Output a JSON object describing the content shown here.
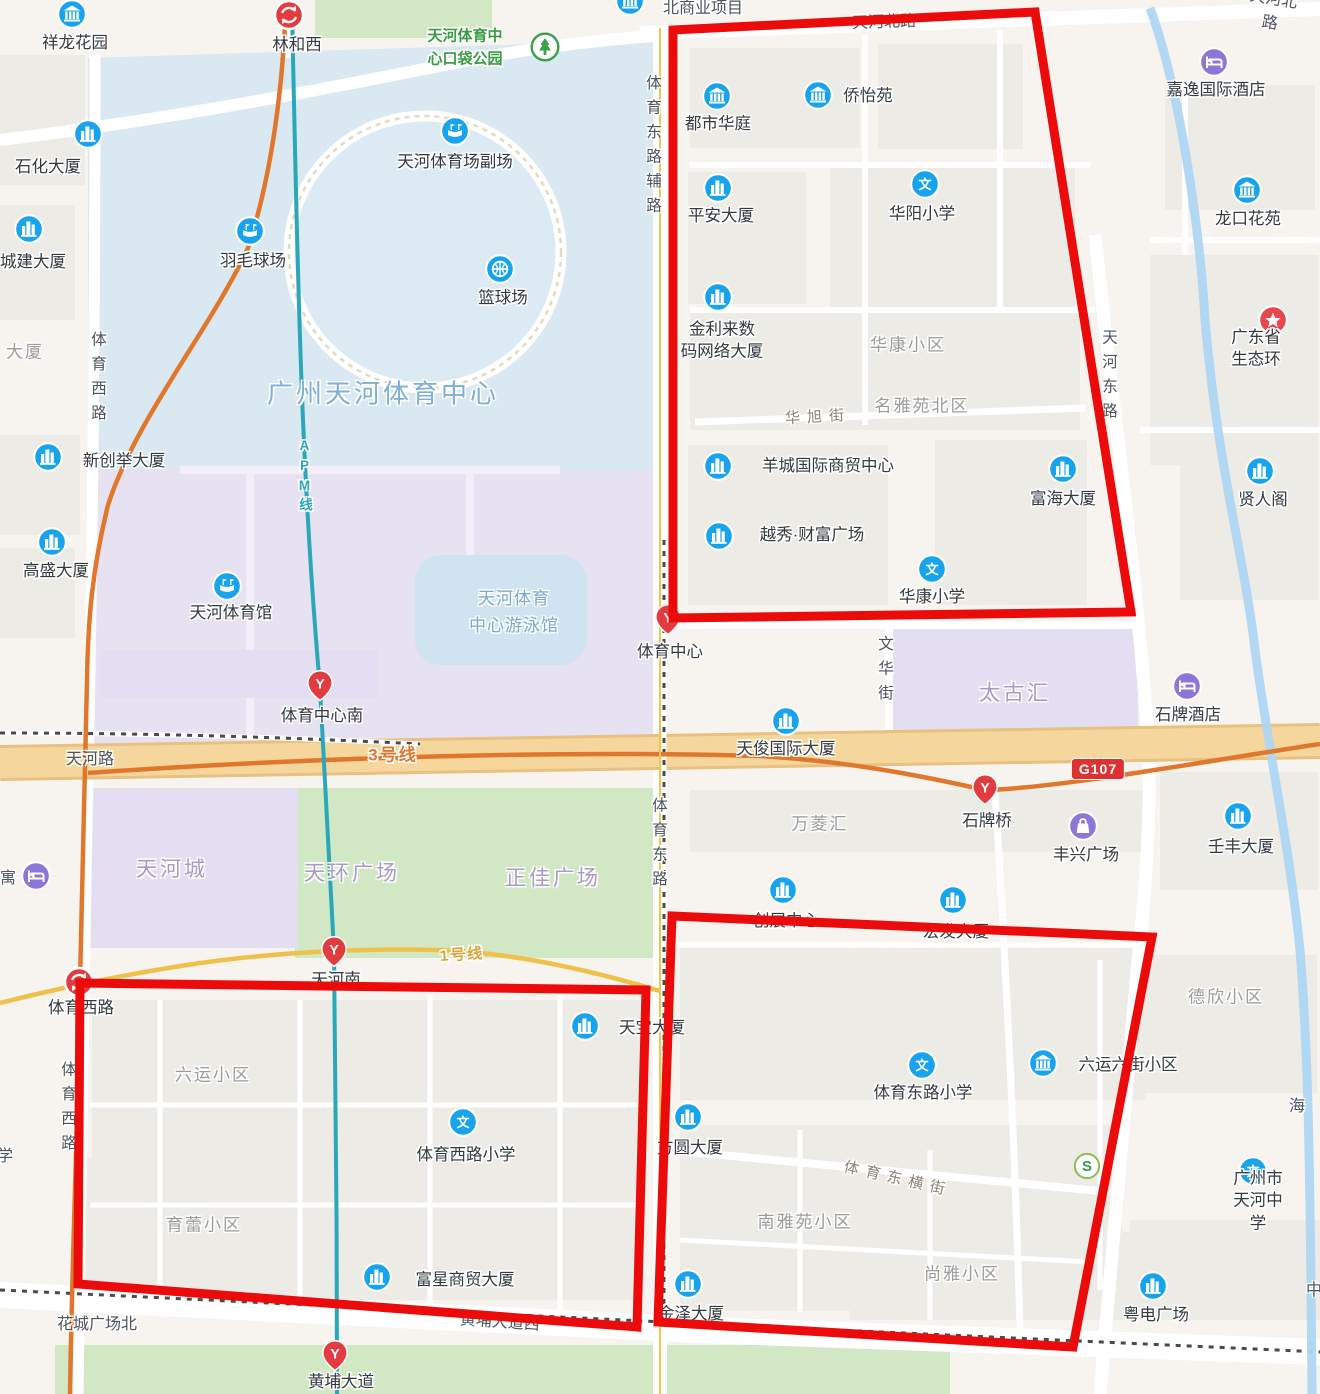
{
  "colors": {
    "red_zone": "#ec0b0b",
    "poi_blue": "#17a3ee",
    "metro_red": "#e23c40",
    "poi_purple": "#8a77d8",
    "park_green": "#3aa04a",
    "line3_orange": "#e0772c",
    "apm_teal": "#2aa7b8",
    "line1_yellow": "#e8b64b",
    "main_road": "#f3cf93",
    "water_blue": "#d9e8f1",
    "mall_purple": "#e4def2"
  },
  "map": {
    "red_zones": [
      {
        "name": "zone-northeast",
        "points": [
          [
            673,
            30
          ],
          [
            1035,
            12
          ],
          [
            1131,
            612
          ],
          [
            673,
            618
          ]
        ]
      },
      {
        "name": "zone-southwest",
        "points": [
          [
            80,
            983
          ],
          [
            646,
            990
          ],
          [
            637,
            1327
          ],
          [
            78,
            1284
          ]
        ]
      },
      {
        "name": "zone-southeast",
        "points": [
          [
            672,
            916
          ],
          [
            1152,
            937
          ],
          [
            1073,
            1347
          ],
          [
            658,
            1322
          ]
        ]
      }
    ],
    "pois": [
      {
        "t": "estate",
        "x": 72,
        "y": 14,
        "label": "祥龙花园",
        "lx": 75,
        "ly": 43
      },
      {
        "t": "interchange",
        "x": 289,
        "y": 15,
        "label": "林和西",
        "lx": 297,
        "ly": 45
      },
      {
        "t": "park",
        "x": 545,
        "y": 47,
        "label": "天河体育中\n心口袋公园",
        "lx": 465,
        "ly": 48,
        "lk": "k-green"
      },
      {
        "t": "estate",
        "x": 630,
        "y": 1,
        "label": "北商业项目",
        "lx": 703,
        "ly": 9,
        "lk": "k-road"
      },
      {
        "t": "office",
        "x": 88,
        "y": 134,
        "label": "石化大厦",
        "lx": 48,
        "ly": 167
      },
      {
        "t": "office",
        "x": 29,
        "y": 229,
        "label": "城建大厦",
        "lx": 33,
        "ly": 262
      },
      {
        "t": "stadium",
        "x": 455,
        "y": 131,
        "label": "天河体育场副场",
        "lx": 455,
        "ly": 162
      },
      {
        "t": "stadium",
        "x": 250,
        "y": 231,
        "label": "羽毛球场",
        "lx": 253,
        "ly": 261
      },
      {
        "t": "basketball",
        "x": 500,
        "y": 269,
        "label": "篮球场",
        "lx": 503,
        "ly": 298
      },
      {
        "t": "office",
        "x": 48,
        "y": 457,
        "label": "新创举大厦",
        "lx": 124,
        "ly": 461
      },
      {
        "t": "office",
        "x": 52,
        "y": 542,
        "label": "高盛大厦",
        "lx": 56,
        "ly": 571
      },
      {
        "t": "stadium",
        "x": 227,
        "y": 586,
        "label": "天河体育馆",
        "lx": 231,
        "ly": 613
      },
      {
        "t": "estate",
        "x": 717,
        "y": 96,
        "label": "都市华庭",
        "lx": 718,
        "ly": 124
      },
      {
        "t": "estate",
        "x": 818,
        "y": 95,
        "label": "侨怡苑",
        "lx": 868,
        "ly": 96
      },
      {
        "t": "office",
        "x": 718,
        "y": 188,
        "label": "平安大厦",
        "lx": 721,
        "ly": 216
      },
      {
        "t": "school",
        "x": 925,
        "y": 184,
        "label": "华阳小学",
        "lx": 922,
        "ly": 214
      },
      {
        "t": "hotel",
        "x": 1214,
        "y": 62,
        "label": "嘉逸国际酒店",
        "lx": 1216,
        "ly": 90
      },
      {
        "t": "estate",
        "x": 1247,
        "y": 190,
        "label": "龙口花苑",
        "lx": 1248,
        "ly": 219
      },
      {
        "t": "office",
        "x": 718,
        "y": 297,
        "label": "金利来数\n码网络大厦",
        "lx": 722,
        "ly": 341
      },
      {
        "t": "gov",
        "x": 1273,
        "y": 320,
        "label": "广东省生态环",
        "lx": 1256,
        "ly": 349
      },
      {
        "t": "office",
        "x": 718,
        "y": 466,
        "label": "羊城国际商贸中心",
        "lx": 828,
        "ly": 466
      },
      {
        "t": "office",
        "x": 719,
        "y": 536,
        "label": "越秀·财富广场",
        "lx": 812,
        "ly": 535
      },
      {
        "t": "office",
        "x": 1063,
        "y": 469,
        "label": "富海大厦",
        "lx": 1063,
        "ly": 499
      },
      {
        "t": "office",
        "x": 1260,
        "y": 471,
        "label": "贤人阁",
        "lx": 1263,
        "ly": 500
      },
      {
        "t": "school",
        "x": 932,
        "y": 569,
        "label": "华康小学",
        "lx": 932,
        "ly": 597
      },
      {
        "t": "metro",
        "x": 668,
        "y": 620,
        "label": "体育中心",
        "lx": 670,
        "ly": 652
      },
      {
        "t": "hotel",
        "x": 1187,
        "y": 686,
        "label": "石牌酒店",
        "lx": 1188,
        "ly": 715
      },
      {
        "t": "office",
        "x": 786,
        "y": 721,
        "label": "天俊国际大厦",
        "lx": 786,
        "ly": 749
      },
      {
        "t": "metro",
        "x": 320,
        "y": 686,
        "label": "体育中心南",
        "lx": 322,
        "ly": 716
      },
      {
        "t": "hotel",
        "x": 36,
        "y": 876,
        "label": "",
        "lx": 36,
        "ly": 876
      },
      {
        "t": "metro",
        "x": 985,
        "y": 790,
        "label": "石牌桥",
        "lx": 987,
        "ly": 821
      },
      {
        "t": "shopping",
        "x": 1083,
        "y": 826,
        "label": "丰兴广场",
        "lx": 1086,
        "ly": 855
      },
      {
        "t": "office",
        "x": 1238,
        "y": 816,
        "label": "壬丰大厦",
        "lx": 1241,
        "ly": 847
      },
      {
        "t": "office",
        "x": 783,
        "y": 890,
        "label": "创展中心",
        "lx": 786,
        "ly": 921
      },
      {
        "t": "office",
        "x": 953,
        "y": 900,
        "label": "宏发大厦",
        "lx": 956,
        "ly": 932
      },
      {
        "t": "interchange",
        "x": 79,
        "y": 982,
        "label": "体育西路",
        "lx": 81,
        "ly": 1008
      },
      {
        "t": "metro",
        "x": 334,
        "y": 952,
        "label": "天河南",
        "lx": 336,
        "ly": 980
      },
      {
        "t": "office",
        "x": 585,
        "y": 1026,
        "label": "天宝大厦",
        "lx": 652,
        "ly": 1028
      },
      {
        "t": "school",
        "x": 463,
        "y": 1122,
        "label": "体育西路小学",
        "lx": 466,
        "ly": 1155
      },
      {
        "t": "office",
        "x": 377,
        "y": 1277,
        "label": "富星商贸大厦",
        "lx": 465,
        "ly": 1280
      },
      {
        "t": "metro",
        "x": 335,
        "y": 1356,
        "label": "黄埔大道",
        "lx": 341,
        "ly": 1382
      },
      {
        "t": "office",
        "x": 688,
        "y": 1117,
        "label": "方圆大厦",
        "lx": 690,
        "ly": 1148
      },
      {
        "t": "school",
        "x": 922,
        "y": 1065,
        "label": "体育东路小学",
        "lx": 923,
        "ly": 1093
      },
      {
        "t": "estate",
        "x": 1043,
        "y": 1063,
        "label": "六运六街小区",
        "lx": 1128,
        "ly": 1065
      },
      {
        "t": "office",
        "x": 688,
        "y": 1284,
        "label": "金泽大厦",
        "lx": 691,
        "ly": 1314
      },
      {
        "t": "school",
        "x": 1253,
        "y": 1171,
        "label": "广州市天河中学",
        "lx": 1258,
        "ly": 1201
      },
      {
        "t": "office",
        "x": 1153,
        "y": 1286,
        "label": "粤电广场",
        "lx": 1156,
        "ly": 1315
      },
      {
        "t": "bank",
        "x": 1087,
        "y": 1166,
        "label": "",
        "lx": 1087,
        "ly": 1166
      }
    ],
    "labels": [
      {
        "k": "k-road",
        "t": "天河北路",
        "x": 884,
        "y": 20,
        "r": -2
      },
      {
        "k": "k-road",
        "t": "天河北路",
        "x": 1272,
        "y": 9,
        "r": 9
      },
      {
        "k": "k-vroad",
        "t": "体育东路辅路",
        "x": 652,
        "y": 148
      },
      {
        "k": "k-vroad",
        "t": "体育西路",
        "x": 97,
        "y": 380
      },
      {
        "k": "k-vroad",
        "t": "天河东路",
        "x": 1108,
        "y": 378
      },
      {
        "k": "k-waterbig",
        "t": "广州天河体育中心",
        "x": 383,
        "y": 392
      },
      {
        "k": "k-area",
        "t": "华康小区",
        "x": 908,
        "y": 343
      },
      {
        "k": "k-area",
        "t": "名雅苑北区",
        "x": 922,
        "y": 404
      },
      {
        "k": "k-street",
        "t": "华旭街",
        "x": 818,
        "y": 416,
        "r": -3
      },
      {
        "k": "k-water",
        "t": "天河体育\n中心游泳馆",
        "x": 514,
        "y": 612
      },
      {
        "k": "k-vroad",
        "t": "文华街",
        "x": 884,
        "y": 672
      },
      {
        "k": "k-purple",
        "t": "太古汇",
        "x": 1015,
        "y": 692
      },
      {
        "k": "k-road",
        "t": "天河路",
        "x": 90,
        "y": 757
      },
      {
        "k": "k-metro3",
        "t": "3号线",
        "x": 393,
        "y": 753
      },
      {
        "k": "k-area",
        "t": "万菱汇",
        "x": 820,
        "y": 822
      },
      {
        "k": "k-purple",
        "t": "天河城",
        "x": 172,
        "y": 868
      },
      {
        "k": "k-purple",
        "t": "天环广场",
        "x": 352,
        "y": 872
      },
      {
        "k": "k-purple",
        "t": "正佳广场",
        "x": 553,
        "y": 877
      },
      {
        "k": "k-vroad",
        "t": "体育东路",
        "x": 658,
        "y": 846
      },
      {
        "k": "k-metro1",
        "t": "1号线",
        "x": 462,
        "y": 954,
        "r": -4
      },
      {
        "k": "k-area",
        "t": "六运小区",
        "x": 213,
        "y": 1073
      },
      {
        "k": "k-vroad",
        "t": "体育西路",
        "x": 67,
        "y": 1110
      },
      {
        "k": "k-area",
        "t": "育蕾小区",
        "x": 204,
        "y": 1223
      },
      {
        "k": "k-area",
        "t": "德欣小区",
        "x": 1226,
        "y": 995
      },
      {
        "k": "k-street",
        "t": "体育东横街",
        "x": 898,
        "y": 1178,
        "r": 13
      },
      {
        "k": "k-area",
        "t": "南雅苑小区",
        "x": 805,
        "y": 1220
      },
      {
        "k": "k-area",
        "t": "尚雅小区",
        "x": 962,
        "y": 1272
      },
      {
        "k": "k-road",
        "t": "黄埔大道西",
        "x": 500,
        "y": 1320,
        "r": 4
      },
      {
        "k": "k-road",
        "t": "花城广场北",
        "x": 97,
        "y": 1322
      },
      {
        "k": "k-apm",
        "t": "APM线",
        "x": 304,
        "y": 477
      },
      {
        "k": "k-road",
        "t": "海",
        "x": 1297,
        "y": 1104
      },
      {
        "k": "k-road",
        "t": "中",
        "x": 1314,
        "y": 1288
      },
      {
        "k": "k-area",
        "t": "大厦",
        "x": 25,
        "y": 350
      },
      {
        "k": "k-road",
        "t": "学",
        "x": 5,
        "y": 1154
      },
      {
        "k": "k-road",
        "t": "寓",
        "x": 8,
        "y": 876
      }
    ],
    "badge": {
      "text": "G107",
      "x": 1098,
      "y": 769
    }
  }
}
